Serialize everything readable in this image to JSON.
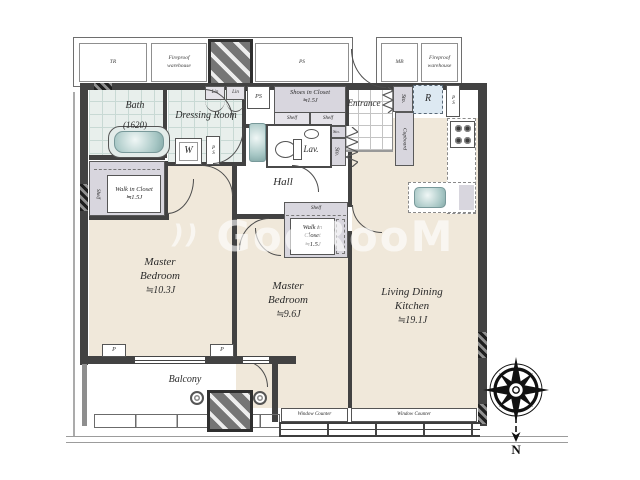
{
  "watermark": {
    "prefix": "))",
    "text": "GooRooM"
  },
  "corridor": {
    "tr": "TR",
    "fireproof_left": "Fireproof warehouse",
    "ps": "PS",
    "mb": "MB",
    "fireproof_right": "Fireproof warehouse"
  },
  "rooms": {
    "bath": {
      "name": "Bath",
      "size": "(1620)"
    },
    "dressing_room": {
      "name": "Dressing Room"
    },
    "shoes_closet": {
      "name": "Shoes in Closet",
      "size": "≒1.5J"
    },
    "entrance": {
      "name": "Entrance"
    },
    "lavatory": {
      "name": "Lav."
    },
    "hall": {
      "name": "Hall"
    },
    "walk_in_closet_left": {
      "name": "Walk in Closet",
      "size": "≒1.5J"
    },
    "walk_in_closet_mid": {
      "name": "Walk in Closet",
      "size": "≒1.5J"
    },
    "master_bedroom_1": {
      "name": "Master Bedroom",
      "size": "≒10.3J"
    },
    "master_bedroom_2": {
      "name": "Master Bedroom",
      "size": "≒9.6J"
    },
    "ldk": {
      "name": "Living Dining Kitchen",
      "size": "≒19.1J"
    },
    "balcony": {
      "name": "Balcony"
    }
  },
  "fixtures": {
    "washer": "W",
    "fridge": "R",
    "cupboard": "Cupboard",
    "storage": "Sto.",
    "linen": "Lin",
    "pipe_space": "PS",
    "shelf": "Shelf",
    "pillar": "P",
    "window_counter": "Window Counter"
  },
  "compass": {
    "north": "N"
  },
  "colors": {
    "wall": "#424242",
    "floor_beige": "#f0e8da",
    "tile_teal": "#e8efec",
    "closet_gray": "#d8d6de",
    "fridge_blue": "#dde9f2",
    "fixture_teal": "#a6c6c4"
  }
}
